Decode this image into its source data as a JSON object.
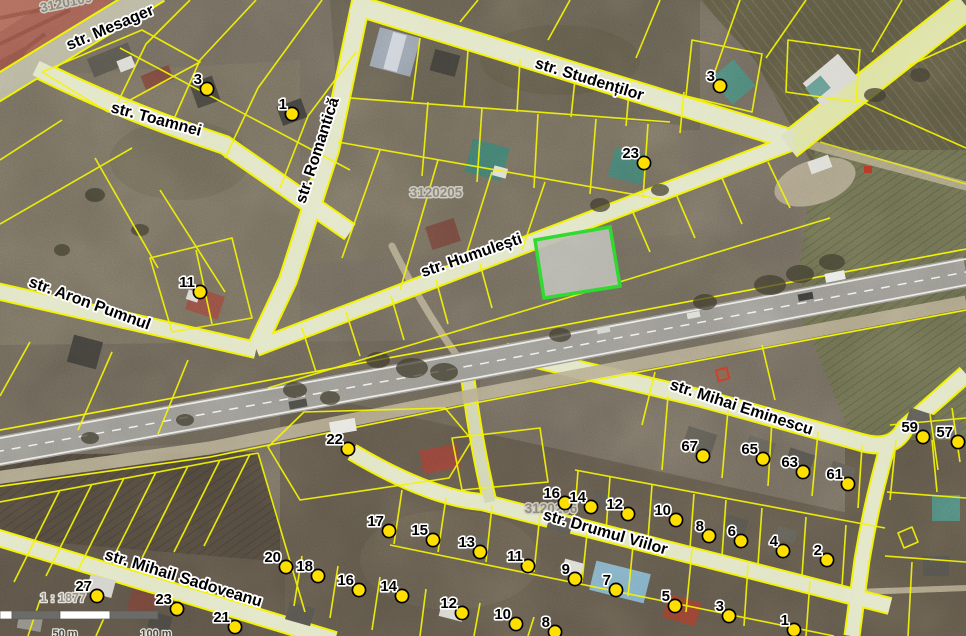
{
  "map": {
    "streets": [
      {
        "name": "str. Mesager",
        "x": 112,
        "y": 32,
        "rot": -23,
        "size": 16
      },
      {
        "name": "str. Toamnei",
        "x": 155,
        "y": 124,
        "rot": 15,
        "size": 16
      },
      {
        "name": "str. Romantică",
        "x": 322,
        "y": 152,
        "rot": -72,
        "size": 16
      },
      {
        "name": "str. Studenților",
        "x": 588,
        "y": 84,
        "rot": 17,
        "size": 16
      },
      {
        "name": "str. Humulești",
        "x": 473,
        "y": 260,
        "rot": -19,
        "size": 16
      },
      {
        "name": "str. Aron Pumnul",
        "x": 88,
        "y": 308,
        "rot": 20,
        "size": 16
      },
      {
        "name": "str. Mihai Eminescu",
        "x": 740,
        "y": 412,
        "rot": 18,
        "size": 16
      },
      {
        "name": "str. Drumul Viilor",
        "x": 604,
        "y": 537,
        "rot": 16,
        "size": 16
      },
      {
        "name": "str. Mihail Sadoveanu",
        "x": 182,
        "y": 583,
        "rot": 17,
        "size": 16
      }
    ],
    "parcel_ids": [
      {
        "text": "3120109",
        "x": 67,
        "y": 7,
        "rot": -12
      },
      {
        "text": "3120205",
        "x": 436,
        "y": 197,
        "rot": 0
      },
      {
        "text": "3120206",
        "x": 551,
        "y": 513,
        "rot": 0
      }
    ],
    "markers": [
      {
        "label": "3",
        "x": 207,
        "y": 89
      },
      {
        "label": "1",
        "x": 292,
        "y": 114
      },
      {
        "label": "23",
        "x": 644,
        "y": 163
      },
      {
        "label": "3",
        "x": 720,
        "y": 86
      },
      {
        "label": "11",
        "x": 200,
        "y": 292
      },
      {
        "label": "22",
        "x": 348,
        "y": 449
      },
      {
        "label": "17",
        "x": 389,
        "y": 531
      },
      {
        "label": "15",
        "x": 433,
        "y": 540
      },
      {
        "label": "13",
        "x": 480,
        "y": 552
      },
      {
        "label": "11",
        "x": 528,
        "y": 566
      },
      {
        "label": "9",
        "x": 575,
        "y": 579
      },
      {
        "label": "7",
        "x": 616,
        "y": 590
      },
      {
        "label": "5",
        "x": 675,
        "y": 606
      },
      {
        "label": "3",
        "x": 729,
        "y": 616
      },
      {
        "label": "1",
        "x": 794,
        "y": 630
      },
      {
        "label": "16",
        "x": 565,
        "y": 503
      },
      {
        "label": "14",
        "x": 591,
        "y": 507
      },
      {
        "label": "12",
        "x": 628,
        "y": 514
      },
      {
        "label": "10",
        "x": 676,
        "y": 520
      },
      {
        "label": "8",
        "x": 709,
        "y": 536
      },
      {
        "label": "6",
        "x": 741,
        "y": 541
      },
      {
        "label": "4",
        "x": 783,
        "y": 551
      },
      {
        "label": "2",
        "x": 827,
        "y": 560
      },
      {
        "label": "67",
        "x": 703,
        "y": 456
      },
      {
        "label": "65",
        "x": 763,
        "y": 459
      },
      {
        "label": "63",
        "x": 803,
        "y": 472
      },
      {
        "label": "61",
        "x": 848,
        "y": 484
      },
      {
        "label": "59",
        "x": 923,
        "y": 437
      },
      {
        "label": "57",
        "x": 958,
        "y": 442
      },
      {
        "label": "20",
        "x": 286,
        "y": 567
      },
      {
        "label": "18",
        "x": 318,
        "y": 576
      },
      {
        "label": "16",
        "x": 359,
        "y": 590
      },
      {
        "label": "14",
        "x": 402,
        "y": 596
      },
      {
        "label": "12",
        "x": 462,
        "y": 613
      },
      {
        "label": "10",
        "x": 516,
        "y": 624
      },
      {
        "label": "8",
        "x": 555,
        "y": 632
      },
      {
        "label": "27",
        "x": 97,
        "y": 596
      },
      {
        "label": "23",
        "x": 177,
        "y": 609
      },
      {
        "label": "21",
        "x": 235,
        "y": 627
      }
    ],
    "selected_parcel": {
      "stroke": "#2bd42b",
      "fill": "#b6b6ae"
    },
    "scale": {
      "ratio": "1 : 1877",
      "bar_labels": [
        "50 m",
        "100 m"
      ]
    },
    "colors": {
      "parcel_line": "#f4f400",
      "marker_fill": "#ffdf00",
      "marker_stroke": "#000000",
      "street_fill": "#e0e4c2",
      "highway": "#95938c",
      "red_zone": "#9b5a4e"
    }
  }
}
